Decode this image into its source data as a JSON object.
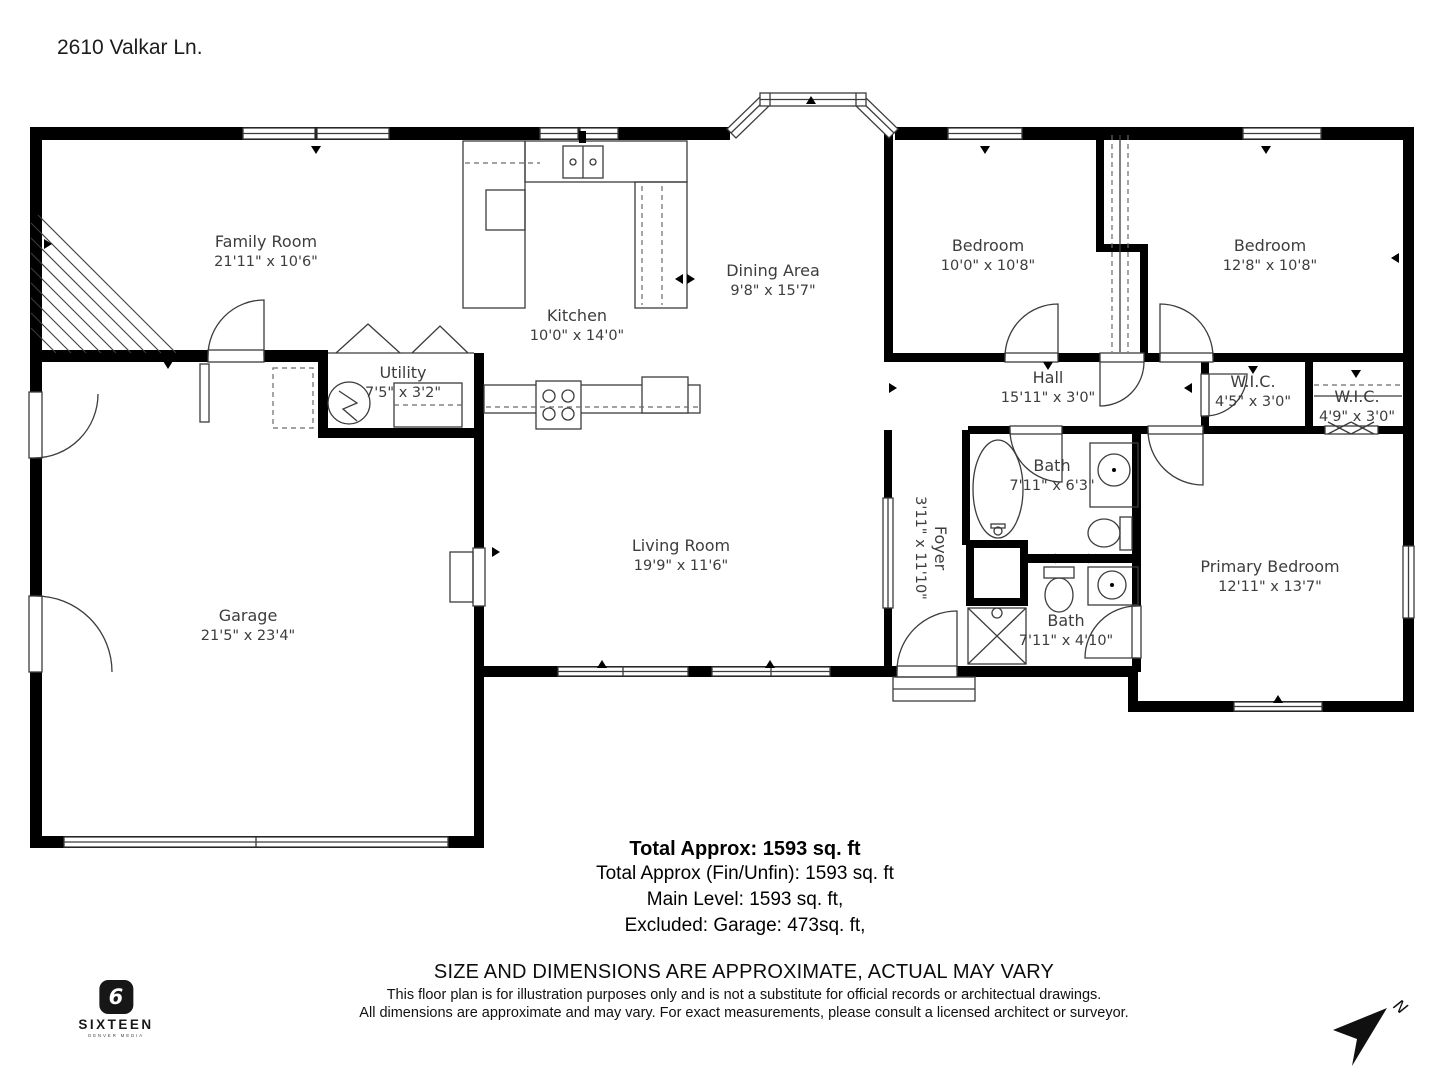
{
  "page": {
    "address": "2610 Valkar Ln."
  },
  "rooms": [
    {
      "name": "Family Room",
      "dims": "21'11\" x 10'6\""
    },
    {
      "name": "Kitchen",
      "dims": "10'0\" x 14'0\""
    },
    {
      "name": "Dining Area",
      "dims": "9'8\" x 15'7\""
    },
    {
      "name": "Bedroom",
      "dims": "10'0\" x 10'8\""
    },
    {
      "name": "Bedroom",
      "dims": "12'8\" x 10'8\""
    },
    {
      "name": "Hall",
      "dims": "15'11\" x 3'0\""
    },
    {
      "name": "W.I.C.",
      "dims": "4'5\" x 3'0\""
    },
    {
      "name": "W.I.C.",
      "dims": "4'9\" x 3'0\""
    },
    {
      "name": "Utility",
      "dims": "7'5\" x 3'2\""
    },
    {
      "name": "Garage",
      "dims": "21'5\" x 23'4\""
    },
    {
      "name": "Living Room",
      "dims": "19'9\" x 11'6\""
    },
    {
      "name": "Foyer",
      "dims": "3'11\" x 11'10\""
    },
    {
      "name": "Bath",
      "dims": "7'11\" x 6'3\""
    },
    {
      "name": "Bath",
      "dims": "7'11\" x 4'10\""
    },
    {
      "name": "Primary Bedroom",
      "dims": "12'11\" x 13'7\""
    }
  ],
  "summary": {
    "total": "Total Approx: 1593 sq. ft",
    "fin_unfin": "Total Approx (Fin/Unfin): 1593 sq. ft",
    "main_level": "Main Level: 1593 sq. ft,",
    "excluded": "Excluded: Garage: 473sq. ft,"
  },
  "disclaimer": {
    "heading": "SIZE AND DIMENSIONS ARE APPROXIMATE, ACTUAL MAY VARY",
    "line1": "This floor plan is for illustration purposes only and is not a substitute for official records or architectual drawings.",
    "line2": "All dimensions are approximate and may vary. For exact measurements, please consult a licensed architect or surveyor."
  },
  "logo": {
    "number": "6",
    "brand": "SIXTEEN",
    "tagline": "DENVER MEDIA"
  },
  "compass": {
    "label": "N"
  }
}
